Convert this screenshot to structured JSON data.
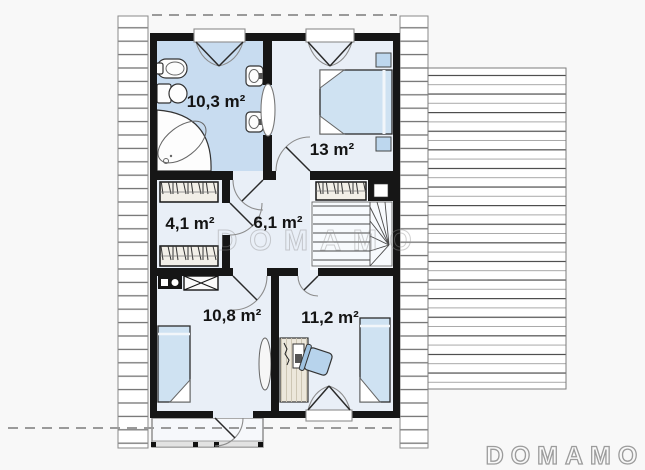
{
  "plan": {
    "type": "floor-plan-upper-storey",
    "rooms": [
      {
        "name": "bathroom",
        "area_label": "10,3 m²"
      },
      {
        "name": "bedroom-1",
        "area_label": "13 m²"
      },
      {
        "name": "wardrobe",
        "area_label": "4,1 m²"
      },
      {
        "name": "hall",
        "area_label": "6,1 m²"
      },
      {
        "name": "bedroom-2",
        "area_label": "10,8 m²"
      },
      {
        "name": "bedroom-3",
        "area_label": "11,2 m²"
      }
    ]
  },
  "watermark_center": "DOMAMO",
  "brand_logo": "DOMAMO",
  "colors": {
    "wall": "#161616",
    "bathroom_fill": "#c8dcf0",
    "room_fill": "#e9eff7",
    "stairs_fill": "#f5f8fc",
    "furniture_blue": "#cfe2f2",
    "chair_fill": "#b7d3ec",
    "nightstand_fill": "#bdd7ee"
  }
}
